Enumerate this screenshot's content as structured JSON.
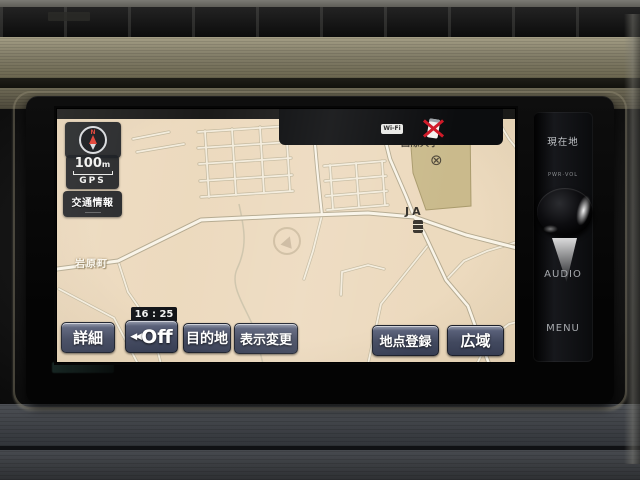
{
  "screen": {
    "status_bar": {
      "wifi_label": "Wi-Fi"
    },
    "overlay": {
      "compass_letter": "N",
      "scale_value": "100",
      "scale_unit": "m",
      "gps_label": "GPS",
      "traffic_button": "交通情報",
      "clock": "16 : 25"
    },
    "map": {
      "town_label": "岩原町",
      "campus_label": "国際大学",
      "poi_label": "JA",
      "police_symbol": "⊗"
    },
    "toolbar": {
      "detail": "詳細",
      "off_prefix": "◀◀",
      "off": "Off",
      "destination": "目的地",
      "display_change": "表示変更",
      "register_point": "地点登録",
      "wide_area": "広域"
    }
  },
  "panel": {
    "current_location": "現在地",
    "pwr_vol": "PWR·VOL",
    "audio": "AUDIO",
    "menu": "MENU"
  },
  "colors": {
    "map_background": "#e9d6bb",
    "campus_fill": "#c9b98a",
    "button_face": "#3e455c",
    "trim_olive": "#847f6b",
    "alert_red": "#cf1322"
  }
}
